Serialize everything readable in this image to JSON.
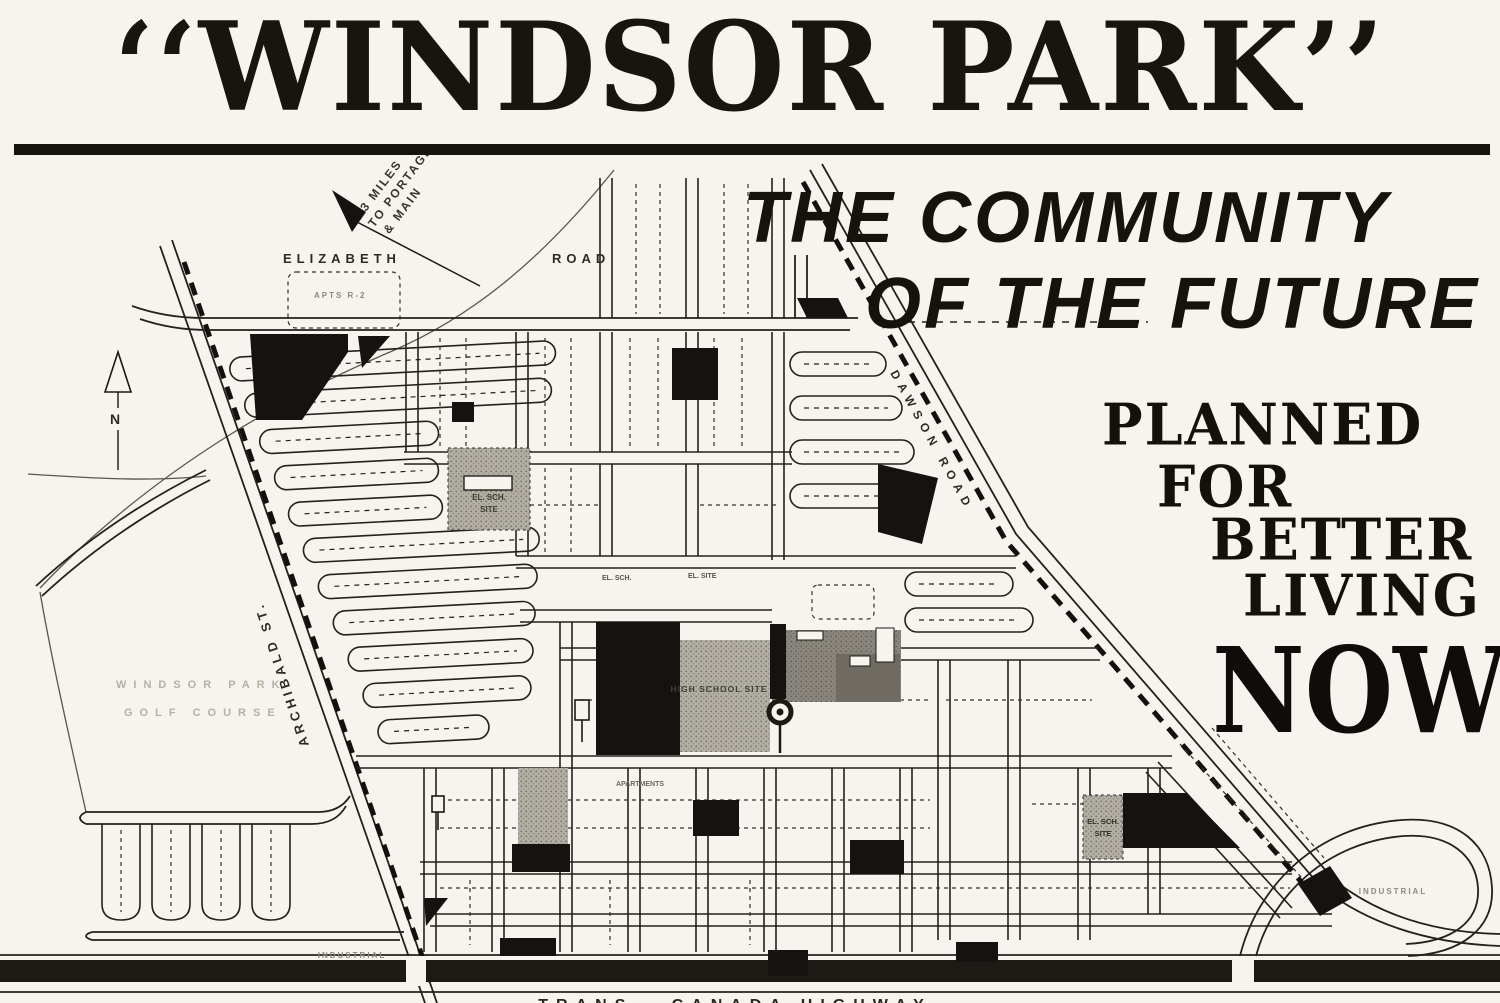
{
  "page": {
    "background": "#f6f4ef",
    "ink": "#15130e",
    "block_black": "#141310",
    "gray_block": "#b2aea4",
    "faint_text": "#b7b0a3"
  },
  "header": {
    "title": "‘‘WINDSOR PARK’’"
  },
  "headline": {
    "line1": "THE COMMUNITY",
    "line2": "OF THE FUTURE",
    "planned": "PLANNED",
    "for": "FOR",
    "better": "BETTER",
    "living": "LIVING",
    "now": "NOW!"
  },
  "map": {
    "roads": {
      "elizabeth": "ELIZABETH",
      "elizabeth_suffix": "ROAD",
      "dawson": "DAWSON ROAD",
      "archibald": "ARCHIBALD ST.",
      "highway": "TRANS - CANADA HIGHWAY"
    },
    "annotations": {
      "miles_1": "3 MILES",
      "miles_2": "TO PORTAGE",
      "miles_3": "& MAIN",
      "north": "N",
      "golf_1": "WINDSOR PARK",
      "golf_2": "GOLF COURSE",
      "apts": "APTS  R-2",
      "school_el1_a": "EL. SCH.",
      "school_el1_b": "SITE",
      "school_high": "HIGH SCHOOL SITE",
      "school_el2_a": "EL. SCH.",
      "school_el2_b": "SITE",
      "el_small_a": "EL. SCH.",
      "el_small_b": "EL. SITE",
      "apartments": "APARTMENTS",
      "industrial_sw": "INDUSTRIAL",
      "industrial_e": "INDUSTRIAL"
    }
  }
}
